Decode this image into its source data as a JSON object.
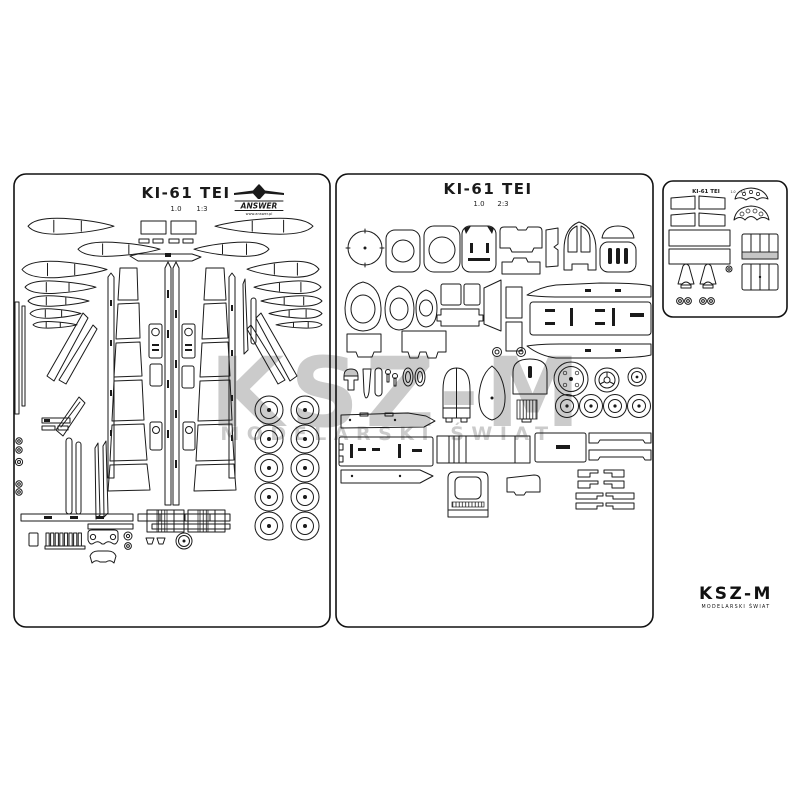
{
  "colors": {
    "ink": "#1a1a1a",
    "shade": "#c6c6c6",
    "watermark": "#cbcbcb",
    "paper": "#ffffff"
  },
  "sheet1": {
    "title": "KI-61 TEI",
    "version": "1.0",
    "number": "1:3"
  },
  "sheet2": {
    "title": "KI-61 TEI",
    "version": "1.0",
    "number": "2:3"
  },
  "sheet3": {
    "title": "KI-61 TEI",
    "version": "1.0",
    "number": "3:3"
  },
  "publisher": {
    "name": "ANSWER",
    "website": "www.answer.pl"
  },
  "watermark": {
    "name": "KSZ-M",
    "tagline": "MODELARSKI ŚWIAT"
  },
  "brand": {
    "name": "KSZ-M",
    "tagline": "MODELARSKI ŚWIAT"
  }
}
